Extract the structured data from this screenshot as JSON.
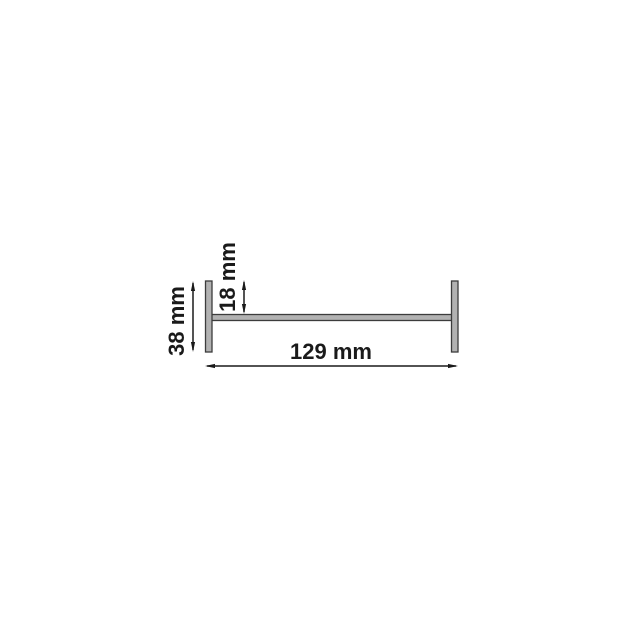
{
  "page": {
    "background_color": "#ffffff"
  },
  "diagram": {
    "description": "H-profile cross-section technical drawing with dimension annotations",
    "unit": "mm",
    "profile": {
      "shape": "H-profile laid horizontally: two vertical end flanges joined by a horizontal web",
      "fill_color": "#b2b2b2",
      "stroke_color": "#3c3c3c"
    },
    "dimension_color": "#1a1a1a",
    "dimensions": [
      {
        "name": "flange-top-to-web",
        "label": "18 mm",
        "value_mm": 18,
        "orientation": "vertical-rotated-text"
      },
      {
        "name": "profile-height",
        "label": "38 mm",
        "value_mm": 38,
        "orientation": "vertical-rotated-text"
      },
      {
        "name": "profile-width",
        "label": "129 mm",
        "value_mm": 129,
        "orientation": "horizontal-text"
      }
    ]
  }
}
